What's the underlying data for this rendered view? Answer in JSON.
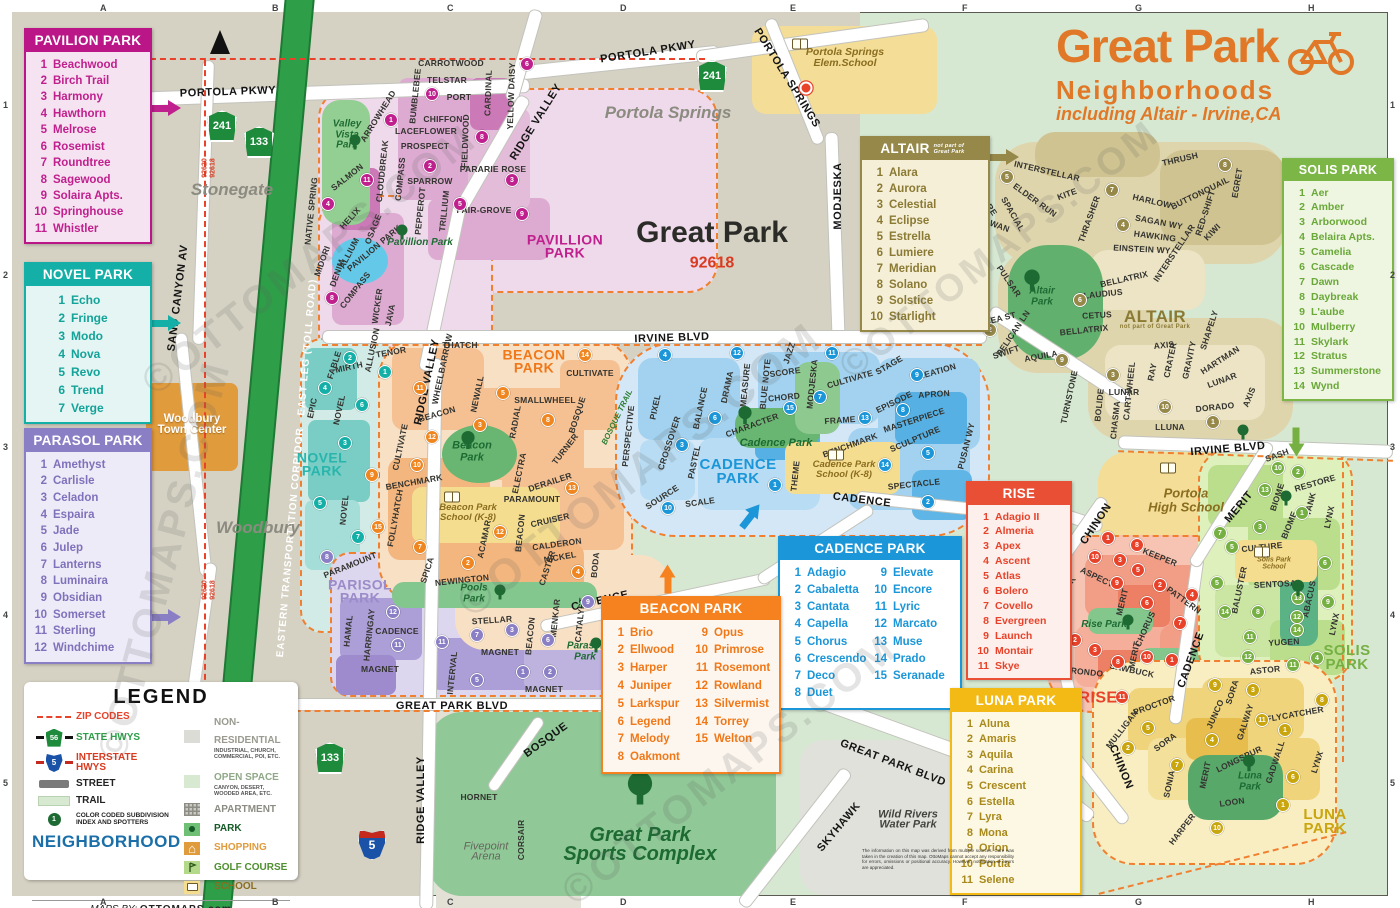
{
  "title": {
    "line1": "Great Park",
    "line2": "Neighborhoods",
    "line3": "including Altair - Irvine,CA"
  },
  "cards": {
    "pavilion": {
      "title": "PAVILION PARK",
      "items": [
        "Beachwood",
        "Birch Trail",
        "Harmony",
        "Hawthorn",
        "Melrose",
        "Rosemist",
        "Roundtree",
        "Sagewood",
        "Solaira Apts.",
        "Springhouse",
        "Whistler"
      ]
    },
    "novel": {
      "title": "NOVEL PARK",
      "items": [
        "Echo",
        "Fringe",
        "Modo",
        "Nova",
        "Revo",
        "Trend",
        "Verge"
      ]
    },
    "parasol": {
      "title": "PARASOL PARK",
      "items": [
        "Amethyst",
        "Carlisle",
        "Celadon",
        "Espaira",
        "Jade",
        "Julep",
        "Lanterns",
        "Luminaira",
        "Obsidian",
        "Somerset",
        "Sterling",
        "Windchime"
      ]
    },
    "altair": {
      "title": "ALTAIR",
      "subtitle": "not part of Great Park",
      "items": [
        "Alara",
        "Aurora",
        "Celestial",
        "Eclipse",
        "Estrella",
        "Lumiere",
        "Meridian",
        "Solano",
        "Solstice",
        "Starlight"
      ]
    },
    "solis": {
      "title": "SOLIS PARK",
      "items": [
        "Aer",
        "Amber",
        "Arborwood",
        "Belaira Apts.",
        "Camelia",
        "Cascade",
        "Dawn",
        "Daybreak",
        "L'aube",
        "Mulberry",
        "Skylark",
        "Stratus",
        "Summerstone",
        "Wynd"
      ]
    },
    "cadence": {
      "title": "CADENCE PARK",
      "items": [
        "Adagio",
        "Cabaletta",
        "Cantata",
        "Capella",
        "Chorus",
        "Crescendo",
        "Deco",
        "Duet",
        "Elevate",
        "Encore",
        "Lyric",
        "Marcato",
        "Muse",
        "Prado",
        "Seranade"
      ]
    },
    "beacon": {
      "title": "BEACON PARK",
      "items": [
        "Brio",
        "Ellwood",
        "Harper",
        "Juniper",
        "Larkspur",
        "Legend",
        "Melody",
        "Oakmont",
        "Opus",
        "Primrose",
        "Rosemont",
        "Rowland",
        "Silvermist",
        "Torrey",
        "Welton"
      ]
    },
    "rise": {
      "title": "RISE",
      "items": [
        "Adagio II",
        "Almeria",
        "Apex",
        "Ascent",
        "Atlas",
        "Bolero",
        "Covello",
        "Evergreen",
        "Launch",
        "Montair",
        "Skye"
      ]
    },
    "luna": {
      "title": "LUNA PARK",
      "items": [
        "Aluna",
        "Amaris",
        "Aquila",
        "Carina",
        "Crescent",
        "Estella",
        "Lyra",
        "Mona",
        "Orion",
        "Portia",
        "Selene"
      ]
    }
  },
  "legend": {
    "title": "LEGEND",
    "left": [
      "ZIP CODES",
      "STATE HWYS",
      "INTERSTATE HWYS",
      "STREET",
      "TRAIL",
      "COLOR CODED SUBDIVISION INDEX AND SPOTTERS",
      "NEIGHBORHOOD"
    ],
    "right": [
      {
        "label": "NON-RESIDENTIAL",
        "sub": "INDUSTRIAL, CHURCH, COMMERCIAL, POI, ETC."
      },
      {
        "label": "OPEN SPACE",
        "sub": "CANYON, DESERT, WOODED AREA, ETC."
      },
      {
        "label": "APARTMENT",
        "sub": ""
      },
      {
        "label": "PARK",
        "sub": ""
      },
      {
        "label": "SHOPPING",
        "sub": ""
      },
      {
        "label": "GOLF COURSE",
        "sub": ""
      },
      {
        "label": "SCHOOL",
        "sub": ""
      }
    ],
    "state_shield": "56",
    "interstate_shield": "5",
    "spotter_num": "1",
    "credit_prefix": "MAPS BY:",
    "credit_name": "OTTOMAPS.com"
  },
  "map": {
    "toll_label": "EASTERN TRANSPORTATION CORRIDOR - EAST LEG (TOLL ROAD)",
    "shields": {
      "ca241": "241",
      "ca133": "133",
      "i5": "5"
    },
    "areas": {
      "stonegate": "Stonegate",
      "woodbury": "Woodbury",
      "woodbury_tc1": "Woodbury",
      "woodbury_tc2": "Town Center",
      "portola_springs": "Portola Springs",
      "ps_school1": "Portola Springs",
      "ps_school2": "Elem.School",
      "great_park": "Great Park",
      "great_park_zip": "92618",
      "fivepoint1": "Fivepoint",
      "fivepoint2": "Arena",
      "wild1": "Wild Rivers",
      "wild2": "Water Park",
      "sports1": "Great Park",
      "sports2": "Sports Complex",
      "valley_vista1": "Valley",
      "valley_vista2": "Vista",
      "valley_vista3": "Park",
      "pavillion_park_g": "Pavillion Park",
      "beacon_park_g1": "Beacon",
      "beacon_park_g2": "Park",
      "pools_park1": "Pools",
      "pools_park2": "Park",
      "parasol_park_g1": "Parasol",
      "parasol_park_g2": "Park",
      "cadence_park_g": "Cadence Park",
      "altair_park1": "Altair",
      "altair_park2": "Park",
      "rise_park": "Rise Park",
      "luna_park_g1": "Luna",
      "luna_park_g2": "Park",
      "beacon_school1": "Beacon Park",
      "beacon_school2": "School (K-8)",
      "cadence_school1": "Cadence Park",
      "cadence_school2": "School (K-8)",
      "portola_hs1": "Portola",
      "portola_hs2": "High School",
      "solis_school1": "Solis Park",
      "solis_school2": "School"
    },
    "neighborhood_labels": {
      "pavillion1": "PAVILLION",
      "pavillion2": "PARK",
      "novel1": "NOVEL",
      "novel2": "PARK",
      "parisol1": "PARISOL",
      "parisol2": "PARK",
      "beacon1": "BEACON",
      "beacon2": "PARK",
      "cadence1": "CADENCE",
      "cadence2": "PARK",
      "altair": "ALTAIR",
      "altair_sub": "not part of Great Park",
      "rise": "RISE",
      "solis1": "SOLIS",
      "solis2": "PARK",
      "luna1": "LUNA",
      "luna2": "PARK"
    },
    "street_labels": [
      "PORTOLA PKWY",
      "PORTOLA PKWY",
      "PORTOLA SPRINGS",
      "SAND CANYON AV",
      "MODJESKA",
      "RIDGE VALLEY",
      "RIDGE VALLEY",
      "RIDGE VALLEY",
      "IRVINE BLVD",
      "IRVINE BLVD",
      "GREAT PARK BLVD",
      "GREAT PARK BLVD",
      "CADENCE",
      "CADENCE",
      "CADENCE",
      "MERIT",
      "CHINON",
      "CHINON",
      "SKYHAWK",
      "BOSQUE",
      "TREBLE",
      "HORNET",
      "CORSAIR",
      "PUSAN WY",
      "PELICAN LN",
      "RHEA ST",
      "SWIFT",
      "AQUILA",
      "ARROWHEAD",
      "CARROTWOOD",
      "BUMBLEBEE",
      "TELSTAR",
      "PORT",
      "CHIFFON",
      "CARDINAL",
      "YELLOW DAISY",
      "LACEFLOWER",
      "PROSPECT",
      "FIELDWOOD",
      "CLOUDBREAK",
      "COMPASS",
      "SPARROW",
      "PARARIE ROSE",
      "NATIVE SPRING",
      "SALMON",
      "HELIX",
      "OSAGE",
      "PAVILION PARK",
      "ALLIUM",
      "MIDORI",
      "DENIM",
      "COMPASS",
      "WICKER",
      "JAVA",
      "TRILLIUM",
      "PEPPEROT",
      "FAIR-GROVE",
      "TENOR",
      "ALLUSION",
      "MIRTH",
      "FABLE",
      "EPIC",
      "NOVEL",
      "NOVEL",
      "THATCH",
      "WHEELBARROW",
      "NEWALL",
      "BEACON",
      "SMALLWHEEL",
      "CULTIVATE",
      "RADIAL",
      "BOSQUE",
      "TURNER",
      "ELECTRA",
      "DERAILER",
      "CULTIVATE",
      "BENCHMARK",
      "PARAMOUNT",
      "FOLLYHATCH",
      "ACAMAR",
      "BEACON",
      "CRUISER",
      "CALDERON",
      "NICKEL",
      "CASTER",
      "BODA",
      "SPICA",
      "NEWINGTON",
      "PARAMOUNT",
      "BOSQUE TRAIL",
      "HAMAL",
      "HARRINGAY",
      "CADENCE",
      "MAGNET",
      "INTERVAL",
      "STELLAR",
      "MAGNET",
      "MAGNET",
      "BEACON",
      "MENKAR",
      "CATALYST",
      "PERSPECTIVE",
      "PIXEL",
      "CROSSOVER",
      "DRAMA",
      "BALANCE",
      "MEASURE",
      "BLUE NOTE",
      "JAZZ",
      "SCORE",
      "CHORD",
      "MODJESKA",
      "CULTIVATE",
      "STAGE",
      "CREATION",
      "APRON",
      "EPISODE",
      "FRAME",
      "CHARACTER",
      "MASTERPIECE",
      "SCULPTURE",
      "BENCHMARK",
      "SPECTACLE",
      "THEME",
      "PASTEL",
      "SOURCE",
      "SCALE",
      "INTERSTELLAR",
      "ELDER RUN",
      "KITE",
      "THRASHER",
      "HARLOW",
      "SAGAN WY",
      "HAWKING",
      "EINSTEIN WY",
      "THRUSH",
      "BUTTONQUAIL",
      "RED-SHIFT",
      "EGRET",
      "KIWI",
      "MARE",
      "SPACIAL",
      "SWAN",
      "PULSAR",
      "BELLATRIX",
      "CLAUDIUS",
      "CETUS",
      "BELLATRIX",
      "INTERSTELLAR",
      "AXIS",
      "SHAPELY",
      "HARTMAN",
      "CRATER",
      "GRAVITY",
      "RAY",
      "LUNAR",
      "DORADO",
      "AXIS",
      "CART-WHEEL",
      "CHASMA",
      "BOLIDE",
      "LUNAR",
      "TURNSTONE",
      "LLUNA",
      "KEEPER",
      "ASPECT",
      "SAWBUCK",
      "MERIT",
      "PATTERN",
      "CHORUS",
      "MERIT",
      "SAWBUCK",
      "RONDO",
      "SASH",
      "RESTORE",
      "BIOME",
      "TANK",
      "LYNX",
      "CULTURE",
      "BIOME",
      "BALUSTER",
      "SENTOSA",
      "ABACUS",
      "YUGEN",
      "LYNX",
      "ASTOR",
      "PROCTOR",
      "MULLIGAN",
      "SORA",
      "JUNCO",
      "SORA",
      "GALWAY",
      "FLYCATCHER",
      "LONGSPUR",
      "GADWALL",
      "MERIT",
      "SONIA",
      "LOON",
      "HARPER",
      "LYNX",
      "92620",
      "92618",
      "92620",
      "92618"
    ],
    "badges": [
      "1",
      "11",
      "2",
      "10",
      "8",
      "3",
      "5",
      "4",
      "6",
      "9",
      "8",
      "2",
      "1",
      "4",
      "6",
      "3",
      "5",
      "7",
      "11",
      "3",
      "5",
      "14",
      "8",
      "12",
      "10",
      "9",
      "15",
      "7",
      "12",
      "2",
      "4",
      "13",
      "4",
      "12",
      "11",
      "9",
      "7",
      "15",
      "6",
      "13",
      "8",
      "3",
      "14",
      "5",
      "1",
      "10",
      "2",
      "12",
      "11",
      "7",
      "3",
      "9",
      "6",
      "1",
      "2",
      "5",
      "8",
      "11",
      "5",
      "7",
      "4",
      "8",
      "6",
      "9",
      "3",
      "10",
      "1",
      "2",
      "1",
      "8",
      "10",
      "3",
      "5",
      "9",
      "6",
      "2",
      "4",
      "7",
      "11",
      "4",
      "8",
      "10",
      "1",
      "2",
      "3",
      "10",
      "2",
      "13",
      "1",
      "3",
      "7",
      "5",
      "6",
      "5",
      "14",
      "8",
      "13",
      "9",
      "12",
      "14",
      "11",
      "12",
      "11",
      "4",
      "3",
      "9",
      "5",
      "2",
      "4",
      "11",
      "1",
      "8",
      "6",
      "1",
      "7",
      "10"
    ],
    "disclaimer": "The information on this map was derived from multiple sources. Care was taken in the creation of this map. OttoMaps cannot accept any responsibility for errors, omissions or positional accuracy. However, notification of errors are appreciated."
  },
  "grid": {
    "cols": [
      "A",
      "B",
      "C",
      "D",
      "E",
      "F",
      "G",
      "H"
    ],
    "rows": [
      "1",
      "2",
      "3",
      "4",
      "5"
    ]
  },
  "watermark": "©OTTOMAPS.COM"
}
